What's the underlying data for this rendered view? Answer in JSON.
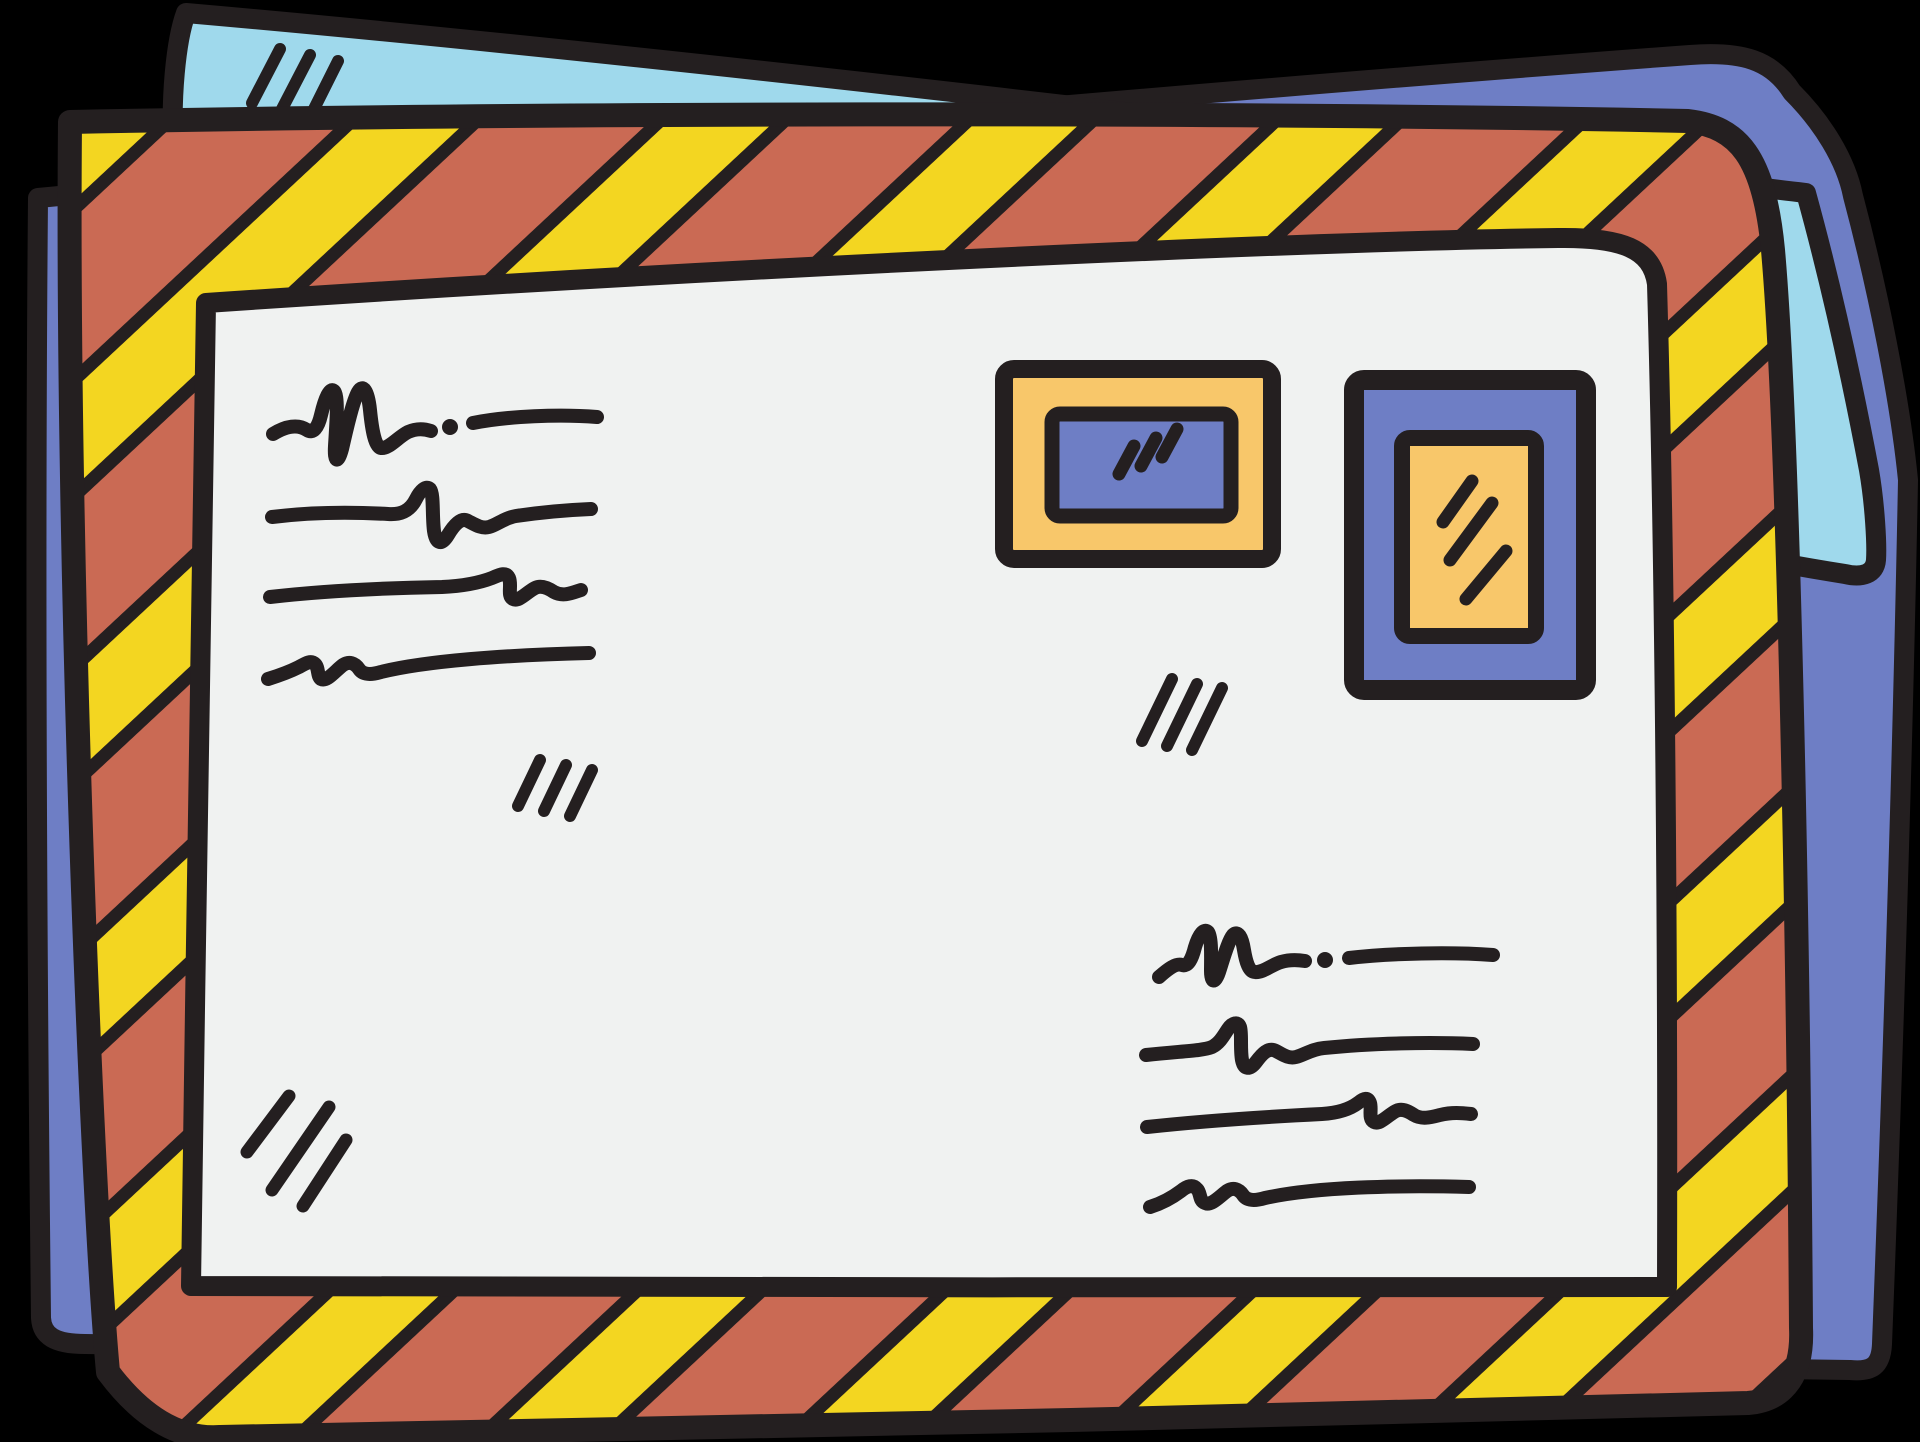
{
  "scene": {
    "background": "#000000",
    "description": "Hand-drawn doodle of an airmail envelope with striped border, two postage stamps and scribbled writing, lying on two stacked papers"
  },
  "colors": {
    "outline": "#241f20",
    "envelope_face": "#f0f2f1",
    "stripe_red": "#ca6a54",
    "stripe_yellow": "#f3d621",
    "stamp_yellow": "#f8c76a",
    "periwinkle": "#6e7ec5",
    "light_blue": "#9fd9ec"
  },
  "papers": [
    {
      "label": "back paper",
      "color_key": "periwinkle",
      "shine_strokes": 0
    },
    {
      "label": "middle paper",
      "color_key": "light_blue",
      "shine_strokes": 3
    }
  ],
  "envelope": {
    "border_pattern": "diagonal red and yellow airmail stripes with black separators",
    "address_scribble_lines": 4,
    "message_scribble_lines": 4,
    "shine_mark_groups_on_face": 2
  },
  "stamps": [
    {
      "label": "landscape stamp",
      "frame_color_key": "stamp_yellow",
      "center_color_key": "periwinkle",
      "shine_strokes": 3
    },
    {
      "label": "portrait stamp",
      "frame_color_key": "periwinkle",
      "center_color_key": "stamp_yellow",
      "shine_strokes": 3
    }
  ]
}
